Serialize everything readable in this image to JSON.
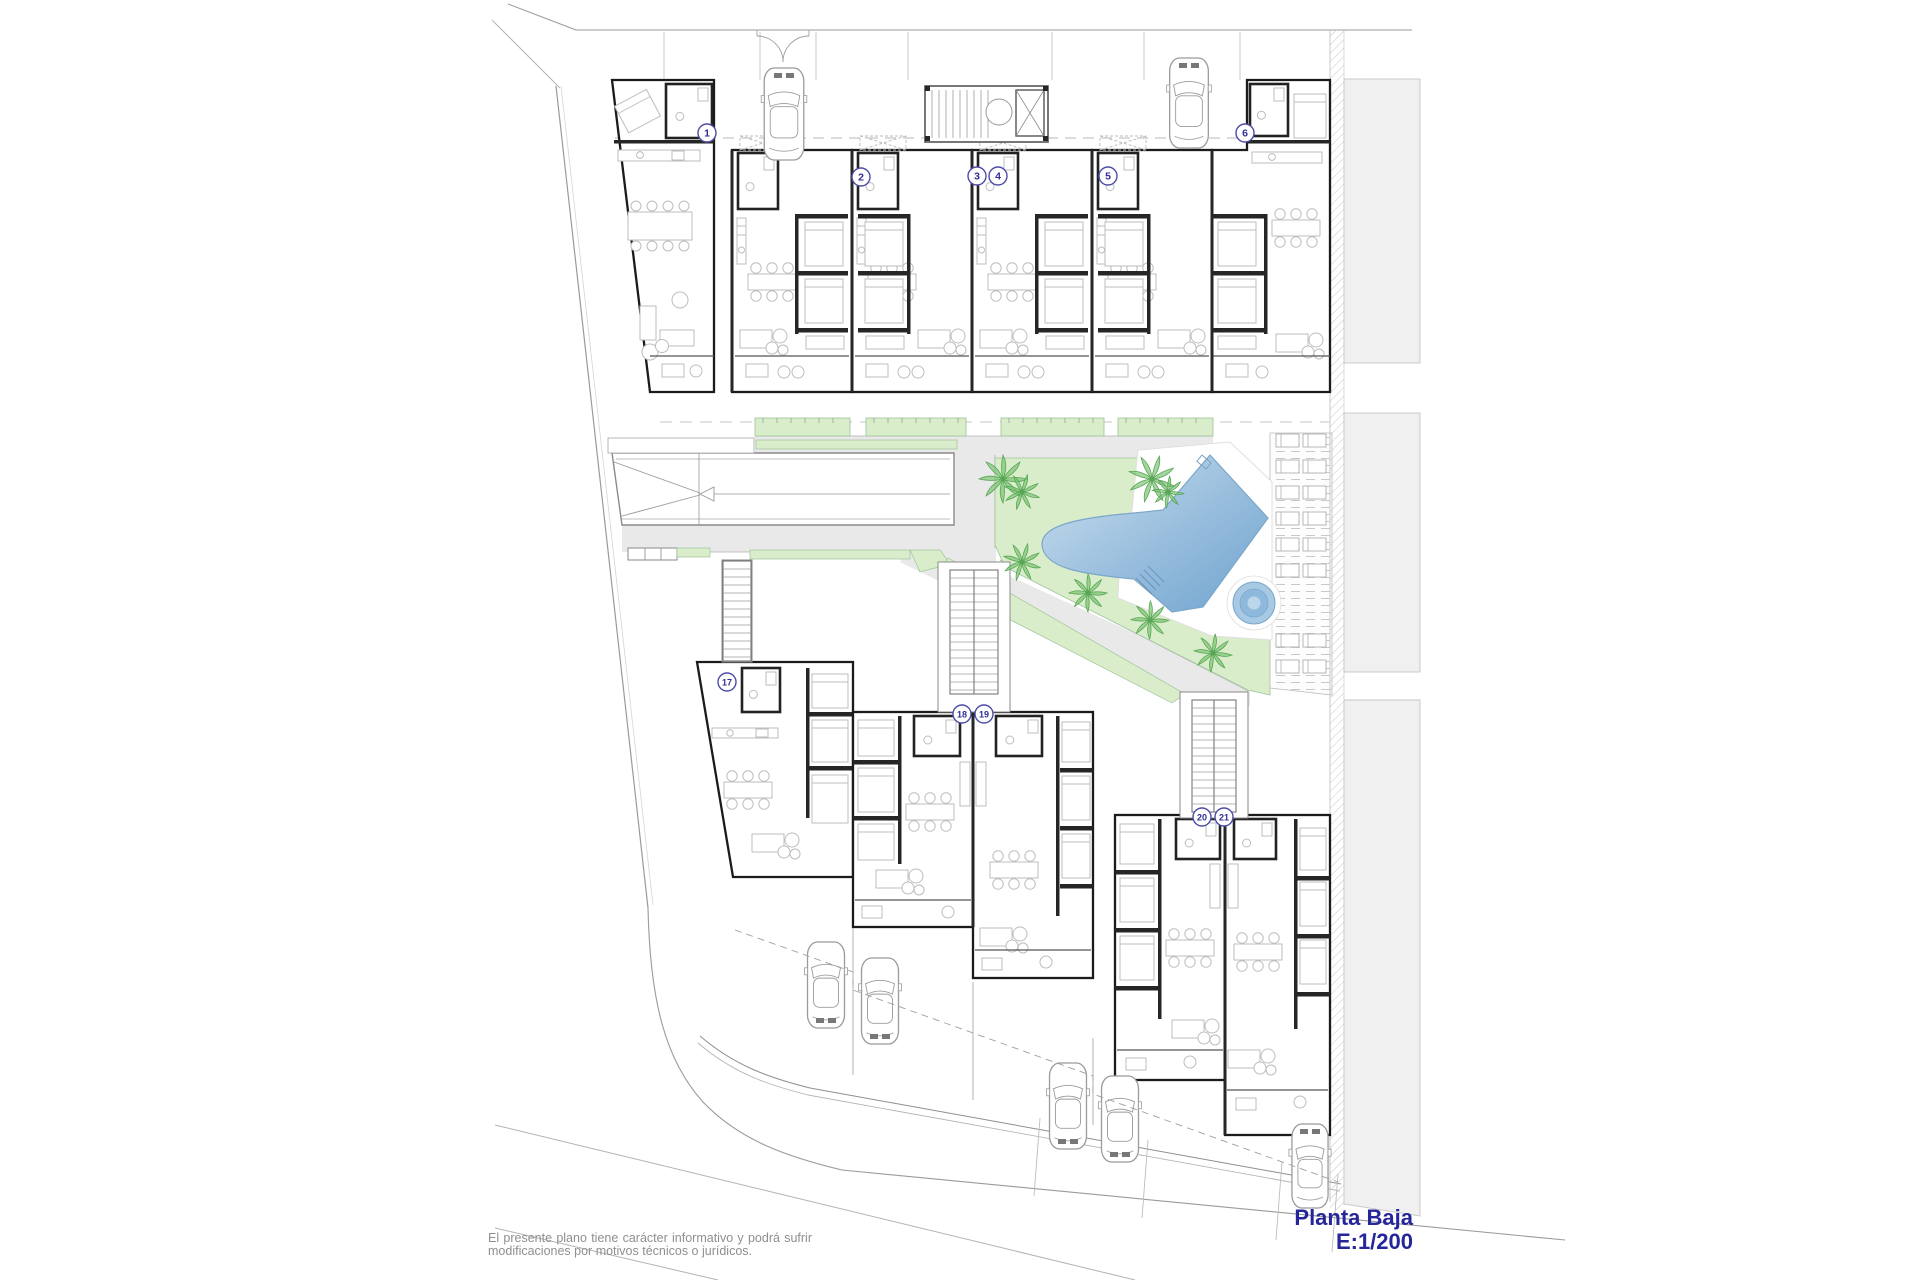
{
  "page": {
    "kind": "architectural ground floor site plan",
    "background": "#ffffff"
  },
  "title_block": {
    "plan_name": "Planta Baja",
    "plan_scale": "E:1/200"
  },
  "disclaimer": {
    "text": "El presente plano tiene carácter informativo y podrá sufrir modificaciones por motivos técnicos o jurídicos."
  },
  "unit_badges": [
    {
      "label": "1",
      "x": 707,
      "y": 133
    },
    {
      "label": "2",
      "x": 861,
      "y": 177
    },
    {
      "label": "3",
      "x": 977,
      "y": 176
    },
    {
      "label": "4",
      "x": 998,
      "y": 176
    },
    {
      "label": "5",
      "x": 1108,
      "y": 176
    },
    {
      "label": "6",
      "x": 1245,
      "y": 133
    },
    {
      "label": "17",
      "x": 727,
      "y": 682
    },
    {
      "label": "18",
      "x": 962,
      "y": 714
    },
    {
      "label": "19",
      "x": 984,
      "y": 714
    },
    {
      "label": "20",
      "x": 1202,
      "y": 817
    },
    {
      "label": "21",
      "x": 1224,
      "y": 817
    }
  ],
  "colors": {
    "title_text": "#26269b",
    "badge_stroke": "#4d4da8",
    "badge_text": "#2f2f96",
    "wall": "#1b1b1b",
    "road_gray": "#e9e9e9",
    "garden_green": "#d9edca",
    "palm_green": "#7cc474",
    "pool_light": "#c7ddef",
    "pool_dark": "#72a7d3",
    "neighbor_gray": "#f0f0f0",
    "disclaimer_text": "#8f8f8f"
  }
}
